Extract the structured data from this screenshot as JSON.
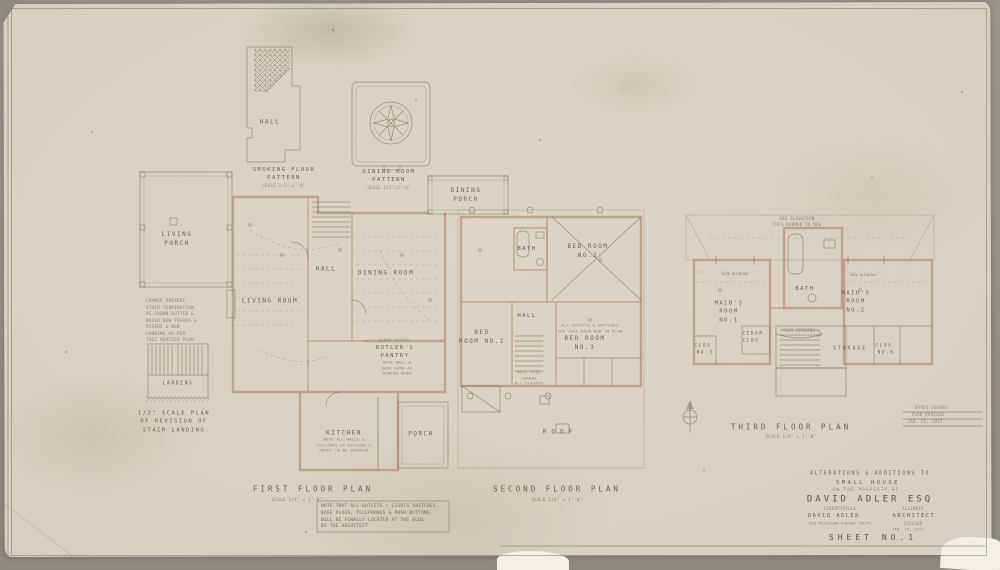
{
  "palette": {
    "paper": "#d6d0c2",
    "ink": "#5a5344",
    "wall_pink": "#bd9187",
    "backing": "#8f8a80"
  },
  "insets": {
    "hall": "HALL",
    "smoking_title": "SMOKING FLOOR\nPATTERN",
    "smoking_scale": "SCALE 1/2\"=1'-0\"",
    "dining_title": "DINING ROOM\nPATTERN",
    "dining_scale": "SCALE 1/2\"=1'-0\""
  },
  "first_floor": {
    "title": "FIRST FLOOR PLAN",
    "scale": "SCALE  1/4\" = 1'-0\"",
    "rooms": {
      "living_porch": "LIVING\nPORCH",
      "dining_porch": "DINING\nPORCH",
      "living_room": "LIVING ROOM",
      "hall": "HALL",
      "dining_room": "DINING ROOM",
      "butlers_pantry": "BUTLER'S\nPANTRY",
      "kitchen": "KITCHEN",
      "porch": "PORCH",
      "floor_outlet": "FLOOR OUTLET"
    },
    "notes": {
      "pantry": "NOTE WALL &\nBASE SAME AS\nDINING ROOM",
      "kitchen": "NOTE ALL WALLS &\nCEILINGS OF KITCHEN &\nENTRY TO BE PAINTED"
    }
  },
  "second_floor": {
    "title": "SECOND FLOOR PLAN",
    "scale": "SCALE  1/4\" = 1'-0\"",
    "rooms": {
      "bath": "BATH",
      "bed1": "BED\nROOM NO.1",
      "bed2": "BED ROOM\nNO.2",
      "bed3": "BED ROOM\nNO.3",
      "hall": "HALL",
      "roof": "ROOF"
    },
    "notes": {
      "bed3": "ALL OUTLETS & SWITCHES\nFOR THIS ROOM NOW IN PLAN",
      "stair": "NOTE THIS\nCHANGE\nALL PLASTER"
    }
  },
  "third_floor": {
    "title": "THIRD FLOOR PLAN",
    "scale": "SCALE  1/4\" = 1'-0\"",
    "rooms": {
      "maid1": "MAID'S\nROOM\nNO.1",
      "maid2": "MAID'S\nROOM\nNO.2",
      "bath": "BATH",
      "cedar": "CEDAR\nCLOS.",
      "clos3": "CLOS.\nNO.3",
      "clos6": "CLOS.\nNO.6",
      "storage": "STORAGE"
    },
    "notes": {
      "dormer": "SEE ELEVATION\nTHIS DORMER IS NEW",
      "new_window_left": "NEW WINDOW",
      "new_window_right": "NEW WINDOW",
      "opening": "THIS OPENING"
    }
  },
  "stair_detail": {
    "note": "CHANGE PRESENT\nSTAIR TERMINATION\nAS SHOWN DOTTED &\nBUILD NEW TREADS &\nRISERS & NEW\nLANDING AS PER\nTHIS REVISED PLAN",
    "landing": "LANDING",
    "title": "1/2\" SCALE PLAN\nOF REVISION OF\nSTAIR LANDING"
  },
  "general_note": "NOTE THAT ALL OUTLETS ( LIGHTS SWITCHES,\nBASE PLUGS, TELEPHONES & PUSH BUTTONS\nWILL BE FINALLY LOCATED AT THE BLDG\nBY THE ARCHITECT",
  "dates_box": {
    "l1": "DATES ISSUED",
    "l2": "PLAN REVISED",
    "l3": "JAN. 25, 1917"
  },
  "title_block": {
    "project_l1": "ALTERATIONS & ADDITIONS TO",
    "project_l2": "SMALL HOUSE",
    "project_l3": "ON THE PROPERTY OF",
    "owner": "DAVID ADLER ESQ",
    "owner_city": "LIBERTYVILLE",
    "owner_state": "ILLINOIS",
    "architect": "DAVID ADLER",
    "architect_role": "ARCHITECT",
    "architect_address": "650 MICHIGAN AVENUE SOUTH",
    "architect_city": "CHICAGO",
    "date": "JAN. 15, 1917",
    "sheet": "SHEET NO.1"
  }
}
